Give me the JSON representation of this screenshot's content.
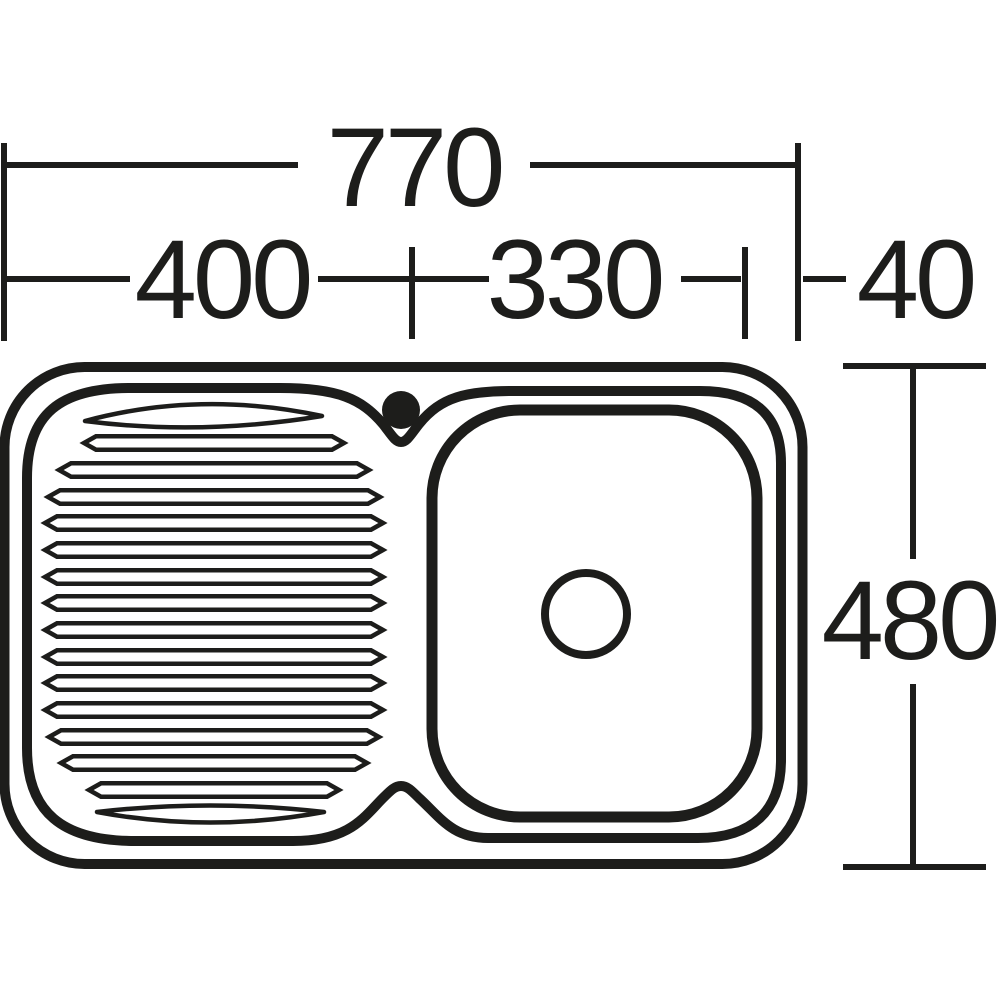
{
  "diagram": {
    "type": "technical-dimension-drawing",
    "subject": "kitchen sink top view with left drainer and single bowl",
    "dimensions": {
      "overall_width": "770",
      "drainer_width": "400",
      "bowl_width": "330",
      "right_offset": "40",
      "overall_depth": "480"
    },
    "colors": {
      "line": "#1d1d1b",
      "bowl_fill": "#28913C",
      "drain_fill": "#ffffff",
      "background": "#ffffff"
    }
  }
}
